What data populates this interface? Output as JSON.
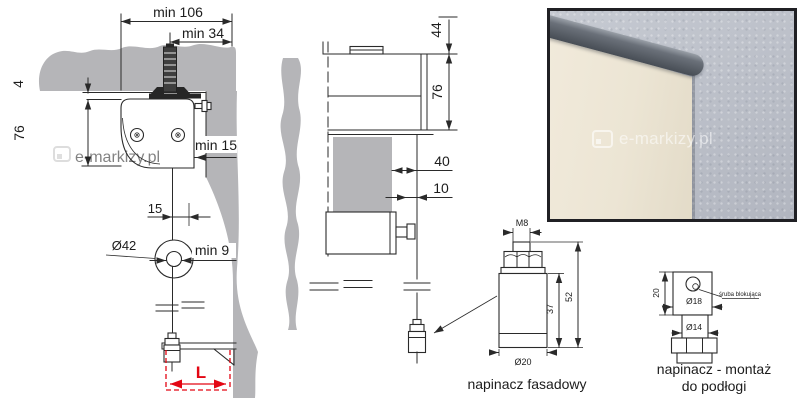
{
  "colors": {
    "accent_red": "#e30613",
    "line": "#2a2a2a",
    "wall_gray": "#b5b5b8",
    "photo_wall": "#bcc0c8",
    "photo_fabric": "#ece5d4",
    "photo_rail": "#5b6067"
  },
  "watermark": {
    "drawing": "e-markizy.pl",
    "photo": "e-markizy.pl"
  },
  "front_view": {
    "dim_min106": "min 106",
    "dim_min34": "min 34",
    "dim_4": "4",
    "dim_76": "76",
    "dim_min15": "min 15",
    "dim_15": "15",
    "dim_dia42": "Ø42",
    "dim_min9": "min 9",
    "dim_L": "L"
  },
  "side_view": {
    "dim_44": "44",
    "dim_76": "76",
    "dim_40": "40",
    "dim_10": "10"
  },
  "facade_tensioner": {
    "label": "napinacz fasadowy",
    "dim_m8": "M8",
    "dim_37": "37",
    "dim_52": "52",
    "dim_dia20": "Ø20"
  },
  "floor_tensioner": {
    "label_line1": "napinacz - montaż",
    "label_line2": "do podłogi",
    "note": "śruba blokująca",
    "dim_20": "20",
    "dim_dia18": "Ø18",
    "dim_dia14": "Ø14"
  }
}
